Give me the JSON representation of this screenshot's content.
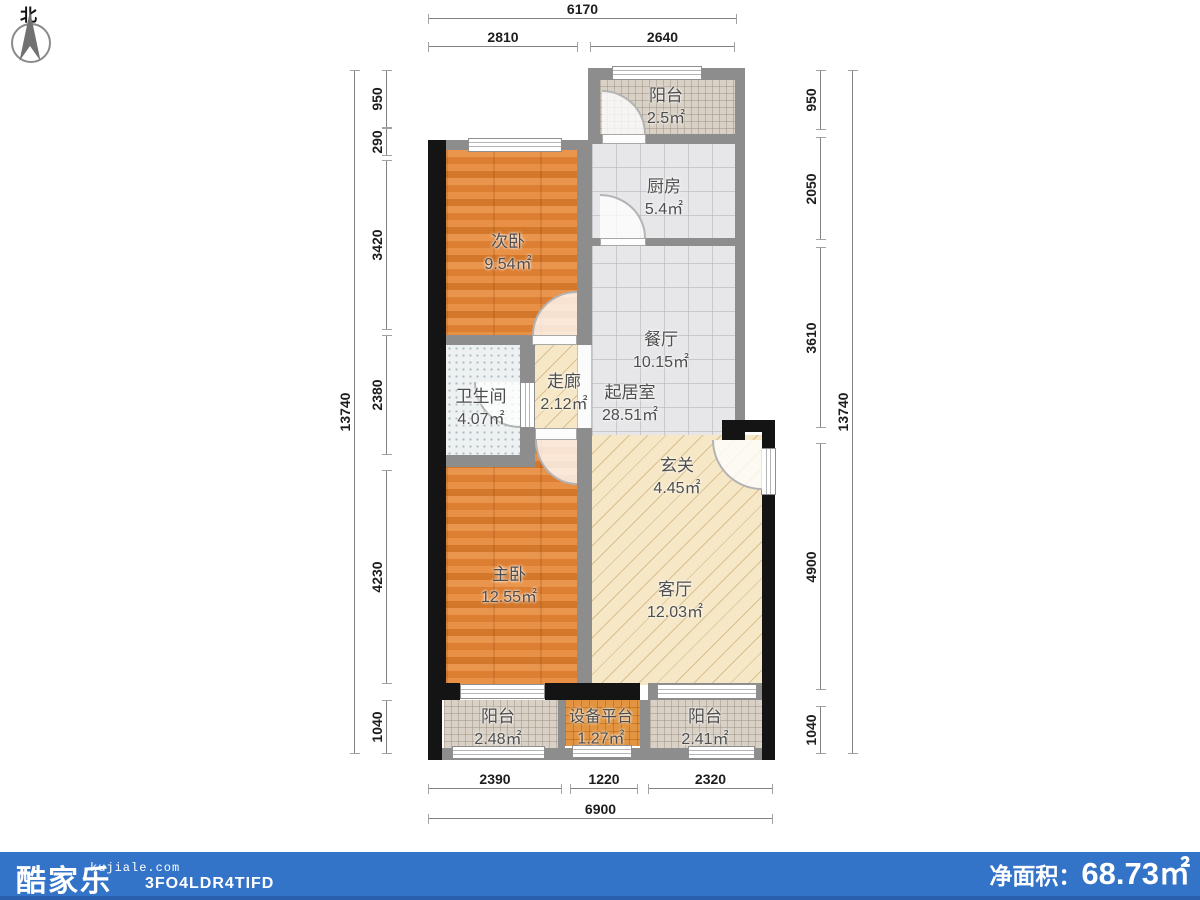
{
  "compass": {
    "north": "北"
  },
  "dims": {
    "top": [
      "6170",
      "2810",
      "2640"
    ],
    "bottom": [
      "2390",
      "1220",
      "2320",
      "6900"
    ],
    "left": [
      "950",
      "290",
      "3420",
      "2380",
      "4230",
      "1040",
      "13740"
    ],
    "right": [
      "950",
      "2050",
      "3610",
      "4900",
      "1040",
      "13740"
    ]
  },
  "rooms": {
    "balcony_top": {
      "name": "阳台",
      "area": "2.5㎡"
    },
    "kitchen": {
      "name": "厨房",
      "area": "5.4㎡"
    },
    "bedroom2": {
      "name": "次卧",
      "area": "9.54㎡"
    },
    "dining": {
      "name": "餐厅",
      "area": "10.15㎡"
    },
    "living_core": {
      "name": "起居室",
      "area": "28.51㎡"
    },
    "corridor": {
      "name": "走廊",
      "area": "2.12㎡"
    },
    "bathroom": {
      "name": "卫生间",
      "area": "4.07㎡"
    },
    "entry": {
      "name": "玄关",
      "area": "4.45㎡"
    },
    "bedroom1": {
      "name": "主卧",
      "area": "12.55㎡"
    },
    "living": {
      "name": "客厅",
      "area": "12.03㎡"
    },
    "balcony_left": {
      "name": "阳台",
      "area": "2.48㎡"
    },
    "equipment": {
      "name": "设备平台",
      "area": "1.27㎡"
    },
    "balcony_right": {
      "name": "阳台",
      "area": "2.41㎡"
    }
  },
  "footer": {
    "logo": "酷家乐",
    "site": "kujiale.com",
    "code": "3FO4LDR4TIFD",
    "net_area_label": "净面积：",
    "net_area_value": "68.73㎡"
  },
  "colors": {
    "footer_bar": "#3474c8",
    "footer_bar_dark": "#2a5fae",
    "wall_gray": "#8d8d8d",
    "wall_black": "#141414",
    "wood_floor": "#e0863e",
    "hatch_floor": "#f6e8c6",
    "tile_floor": "#e7e7e9"
  }
}
